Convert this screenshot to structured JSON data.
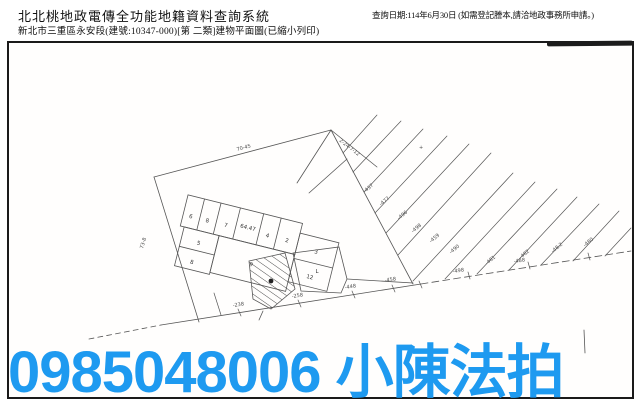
{
  "header": {
    "system_title": "北北桃地政電傳全功能地籍資料查詢系統",
    "document_line": "新北市三重區永安段(建號:10347-000)[第 二類]建物平面圖(已縮小列印)",
    "query_date_note": "查詢日期:114年6月30日 (如需登記謄本,請洽地政事務所申請。)"
  },
  "watermark": {
    "text": "0985048006 小陳法拍",
    "color": "#1e9af0"
  },
  "map": {
    "annotations": [
      "70-45",
      "73-8",
      "2-24-7-12",
      "+",
      "-437",
      "-477",
      "-496",
      "-498",
      "-459",
      "-490",
      "-481",
      "-482",
      "-48.2",
      "-480",
      "-238",
      "-258",
      "-448",
      "-458",
      "-498",
      "-488"
    ],
    "rooms": [
      "6",
      "8",
      "7",
      "64.47",
      "4",
      "2",
      "3",
      "12",
      "5",
      "8",
      "9",
      "L"
    ]
  }
}
